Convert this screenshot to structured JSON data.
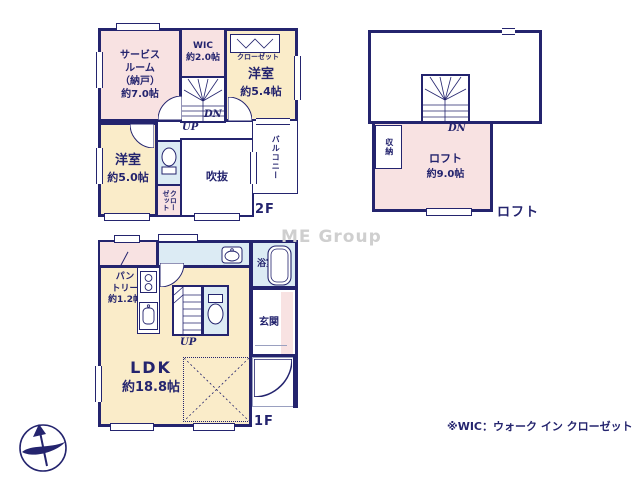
{
  "watermark": "ME Group",
  "footnote": "※WIC：ウォーク イン クローゼット",
  "colors": {
    "wall": "#24246e",
    "room_pink": "#f8e2e2",
    "room_cream": "#faecc9",
    "room_blue": "#dcebf4",
    "text": "#24246e",
    "watermark_gray": "#cfcfcf"
  },
  "icons": {
    "compass": "north-arrow-compass",
    "toilet": "toilet-icon",
    "bathtub": "bathtub-icon",
    "washbasin": "washbasin-icon",
    "stove": "stove-icon",
    "kitchen_sink": "kitchen-sink-icon",
    "stairs": "stairs-icon"
  },
  "f2": {
    "floor_label": "2F",
    "service_room": "サービス\nルーム\n（納戸）\n約7.0帖",
    "wic": "WIC\n約2.0帖",
    "closet_top": "クローゼット",
    "yoshitsu54_name": "洋室",
    "yoshitsu54_size": "約5.4帖",
    "yoshitsu50_name": "洋室",
    "yoshitsu50_size": "約5.0帖",
    "closet_side": "クローゼット",
    "fukinuke": "吹抜",
    "balcony": "バルコニー",
    "up": "UP",
    "dn": "DN"
  },
  "loft": {
    "floor_label": "ロフト",
    "room_name": "ロフト",
    "room_size": "約9.0帖",
    "storage": "収納",
    "dn": "DN"
  },
  "f1": {
    "floor_label": "1F",
    "pantry": "パン\nトリー\n約1.2帖",
    "senmen": "洗面脱衣室",
    "yokushitsu": "浴室",
    "genkan": "玄関",
    "ldk_name": "LDK",
    "ldk_size": "約18.8帖",
    "up": "UP"
  }
}
